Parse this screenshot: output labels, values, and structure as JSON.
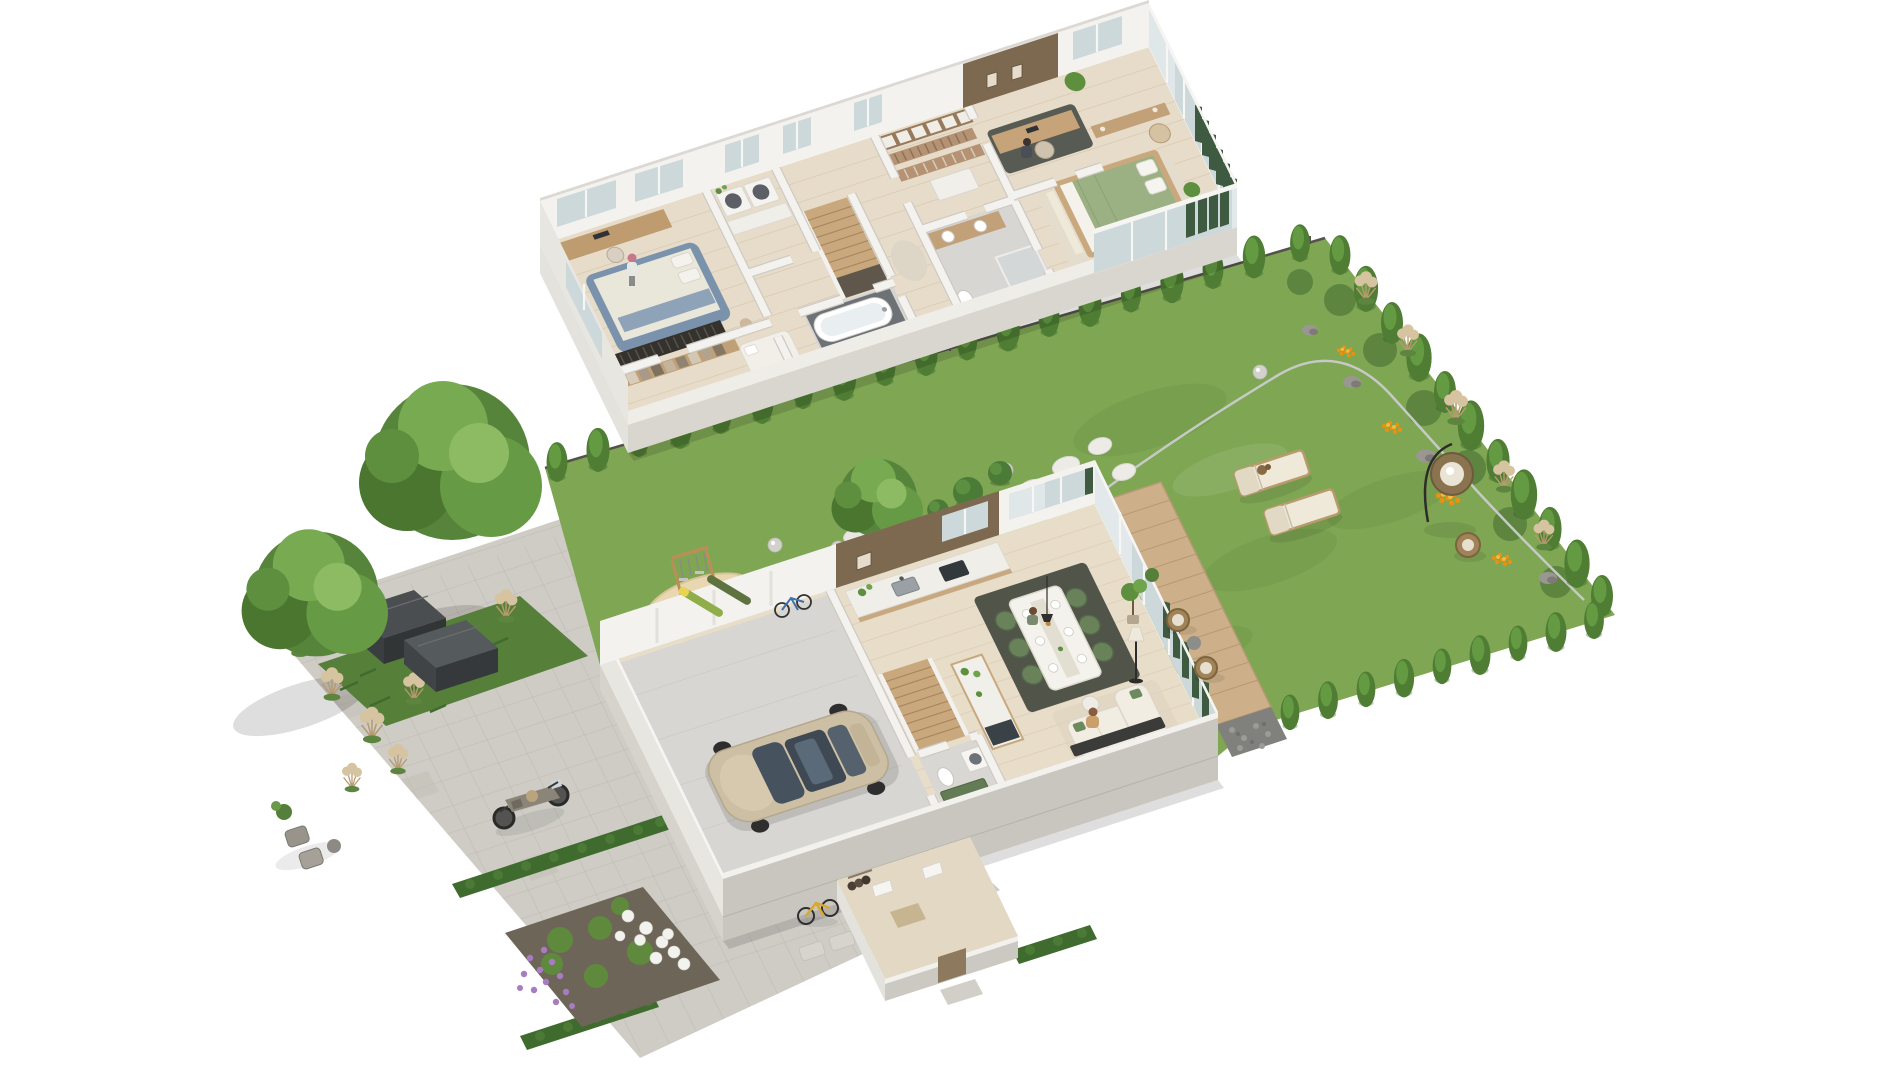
{
  "canvas": {
    "width": 1900,
    "height": 1067,
    "background": "#ffffff",
    "type": "isometric-3d-floor-plan-rendering"
  },
  "colors": {
    "wall_white": "#f3f2ee",
    "wall_shade": "#c9c6bf",
    "wall_light": "#e8e6e1",
    "plinth": "#d9d6d0",
    "roof_edge": "#dcd9d4",
    "floor_wood": "#e7dcc9",
    "floor_wood_ground": "#e8ddc9",
    "garage_floor": "#d8d6d2",
    "tile_gray": "#d6d4d2",
    "accent_wood": "#7d6850",
    "glass": "#ccd8da",
    "curtain_green": "#3e5a40",
    "lawn": "#7fa653",
    "lawn_dark": "#6b9347",
    "paving": "#cfccc6",
    "paving_joint": "#bfbbb3",
    "hedge": "#3f6b2e",
    "conifer": "#4e7d33",
    "conifer_light": "#639a42",
    "canopy": "#55843a",
    "pampas": "#d6c3a0",
    "sand": "#e8d7b0",
    "deck": "#cdb089",
    "gabion": "#80807c",
    "soil": "#6d6557",
    "car_body": "#cdbfa3",
    "car_glass": "#46525e",
    "sofa": "#f1ede3",
    "bed_blue_frame": "#7b92ad",
    "bed_green": "#9cb183",
    "chair_green": "#69825a",
    "rug_dark": "#515449",
    "rug_light": "#e4ddcd",
    "stair_wood": "#c9a87e",
    "counter_white": "#f0eee8",
    "island_wood": "#c8a87e",
    "shed_dark": "#4b4e50",
    "bike_yellow": "#d8a92c",
    "lounger": "#efe9da",
    "flower_white": "#f2f2ee",
    "flower_purple": "#a87cc0",
    "flower_orange": "#e8920f"
  },
  "upper_floor": {
    "name": "upper-floor-plan",
    "rooms": [
      {
        "id": "bedroom-1",
        "items": [
          "desk with monitor",
          "blue upholstered bed",
          "vinyl record console",
          "wardrobe rack",
          "standing person"
        ]
      },
      {
        "id": "walk-in-closet",
        "items": [
          "clothes rail",
          "daybed",
          "pouf"
        ]
      },
      {
        "id": "laundry",
        "items": [
          "washer",
          "dryer",
          "counter"
        ]
      },
      {
        "id": "staircase",
        "items": [
          "wood stairs",
          "stairwell void"
        ]
      },
      {
        "id": "bathroom-1",
        "items": [
          "bathtub",
          "dark tile surround"
        ]
      },
      {
        "id": "wardrobe-2",
        "items": [
          "shelving wall",
          "two clothes racks",
          "white dresser island"
        ]
      },
      {
        "id": "bathroom-2",
        "items": [
          "wood double vanity",
          "two basins",
          "shower",
          "toilet"
        ]
      },
      {
        "id": "home-office",
        "items": [
          "wood accent wall",
          "two framed artworks",
          "desk",
          "chair",
          "seated person",
          "plant"
        ]
      },
      {
        "id": "master-bedroom",
        "items": [
          "green duvet bed",
          "white pillows",
          "console",
          "armchair",
          "two plants",
          "green curtains",
          "sheer curtain"
        ]
      }
    ]
  },
  "ground_floor": {
    "name": "ground-floor-plan",
    "rooms": [
      {
        "id": "garage",
        "items": [
          "champagne car",
          "two snowboards on wall",
          "blue bicycle"
        ]
      },
      {
        "id": "hallway",
        "items": [
          "wood stairs"
        ]
      },
      {
        "id": "wc-utility",
        "items": [
          "toilet",
          "washing machine",
          "green cabinet"
        ]
      },
      {
        "id": "kitchen",
        "items": [
          "dark wood feature wall",
          "window",
          "counter with sink",
          "oven",
          "island with plants",
          "dark cooktop"
        ]
      },
      {
        "id": "dining",
        "items": [
          "white table",
          "six green chairs",
          "dark rug",
          "plates",
          "seated person",
          "pendant lamp"
        ]
      },
      {
        "id": "living",
        "items": [
          "cream sectional sofa",
          "green cushions",
          "seated person",
          "tv console",
          "floor lamp",
          "potted tree",
          "coffee table"
        ]
      },
      {
        "id": "entry",
        "items": [
          "open white doors",
          "doormat",
          "coat nook",
          "entry door",
          "outside step",
          "yellow bicycle outside"
        ]
      }
    ]
  },
  "garden": {
    "elements": [
      {
        "id": "lawn",
        "count": 1
      },
      {
        "id": "north-fence",
        "count": 1
      },
      {
        "id": "conifer-row-north",
        "count": 19
      },
      {
        "id": "conifer-row-east",
        "count": 11
      },
      {
        "id": "conifer-row-south",
        "count": 9
      },
      {
        "id": "sun-loungers",
        "count": 2
      },
      {
        "id": "dog-on-lounger",
        "count": 1
      },
      {
        "id": "hanging-egg-chair",
        "count": 1
      },
      {
        "id": "wicker-chair",
        "count": 1
      },
      {
        "id": "stepping-stones",
        "count": 7
      },
      {
        "id": "light-globes",
        "count": 4
      },
      {
        "id": "pampas-clusters-ne",
        "count": 5
      },
      {
        "id": "orange-flower-patches",
        "count": 5
      },
      {
        "id": "lavender-tufts",
        "count": 4
      },
      {
        "id": "rocks",
        "count": 4
      },
      {
        "id": "boxwood-balls",
        "count": 3
      },
      {
        "id": "round-tree-behind-house",
        "count": 1
      },
      {
        "id": "metal-lawn-edging",
        "count": 1
      },
      {
        "id": "playground",
        "items": [
          "sand pit",
          "wooden swing",
          "ball"
        ]
      }
    ]
  },
  "site": {
    "elements": [
      {
        "id": "driveway-paving",
        "count": 1
      },
      {
        "id": "motorcycle",
        "count": 1
      },
      {
        "id": "storage-shed-boxes",
        "count": 2
      },
      {
        "id": "hedge-rows",
        "count": 3
      },
      {
        "id": "flower-bed",
        "items": [
          "white hydrangeas",
          "purple lavender",
          "green bushes"
        ]
      },
      {
        "id": "large-trees",
        "count": 2
      },
      {
        "id": "pampas-grass-left",
        "count": 8
      },
      {
        "id": "outdoor-chairs",
        "count": 2
      },
      {
        "id": "terrace-deck",
        "count": 1
      },
      {
        "id": "gabion-stone-wall",
        "count": 1
      },
      {
        "id": "deck-chairs",
        "count": 2
      }
    ]
  }
}
